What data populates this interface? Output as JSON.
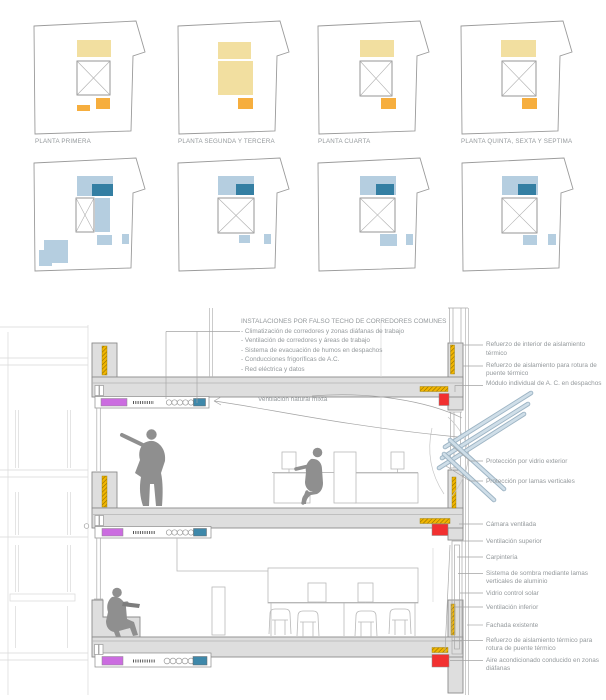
{
  "plans": {
    "row1": [
      {
        "label": "PLANTA PRIMERA"
      },
      {
        "label": "PLANTA SEGUNDA Y TERCERA"
      },
      {
        "label": "PLANTA CUARTA"
      },
      {
        "label": "PLANTA QUINTA, SEXTA Y SEPTIMA"
      }
    ]
  },
  "section": {
    "installations": {
      "title": "INSTALACIONES POR FALSO TECHO DE CORREDORES COMUNES",
      "items": [
        "- Climatización de corredores y zonas diáfanas de trabajo",
        "- Ventilación de corredores y áreas de trabajo",
        "- Sistema de evacuación de humos en despachos",
        "- Conducciones frigoríficas de A.C.",
        "- Red eléctrica y datos"
      ]
    },
    "ventilation_label": "Ventilación natural mixta",
    "right_labels": [
      "Refuerzo de interior de aislamiento térmico",
      "Refuerzo de aislamiento para rotura de puente térmico",
      "Módulo individual de A. C. en despachos",
      "Protección por vidrio exterior",
      "Protección por lamas verticales",
      "Cámara ventilada",
      "Ventilación superior",
      "Carpintería",
      "Sistema de sombra mediante lamas verticales de aluminio",
      "Vidrio control solar",
      "Ventilación inferior",
      "Fachada existente",
      "Refuerzo de aislamiento térmico para rotura de puente térmico",
      "Aire acondicionado conducido en zonas diáfanas"
    ]
  },
  "colors": {
    "plan_yellow_light": "#F2DFA0",
    "plan_orange": "#F6AE3E",
    "plan_blue_light": "#B5CEE0",
    "plan_blue_dark": "#347FA3",
    "section_magenta": "#CB6CE0",
    "section_red": "#F23030",
    "section_blue": "#3E88AA",
    "insulation_yellow": "#F1B501",
    "slab_gray": "#DEDEDE",
    "figure_gray": "#8F8F8F",
    "text_gray": "#94999C"
  }
}
